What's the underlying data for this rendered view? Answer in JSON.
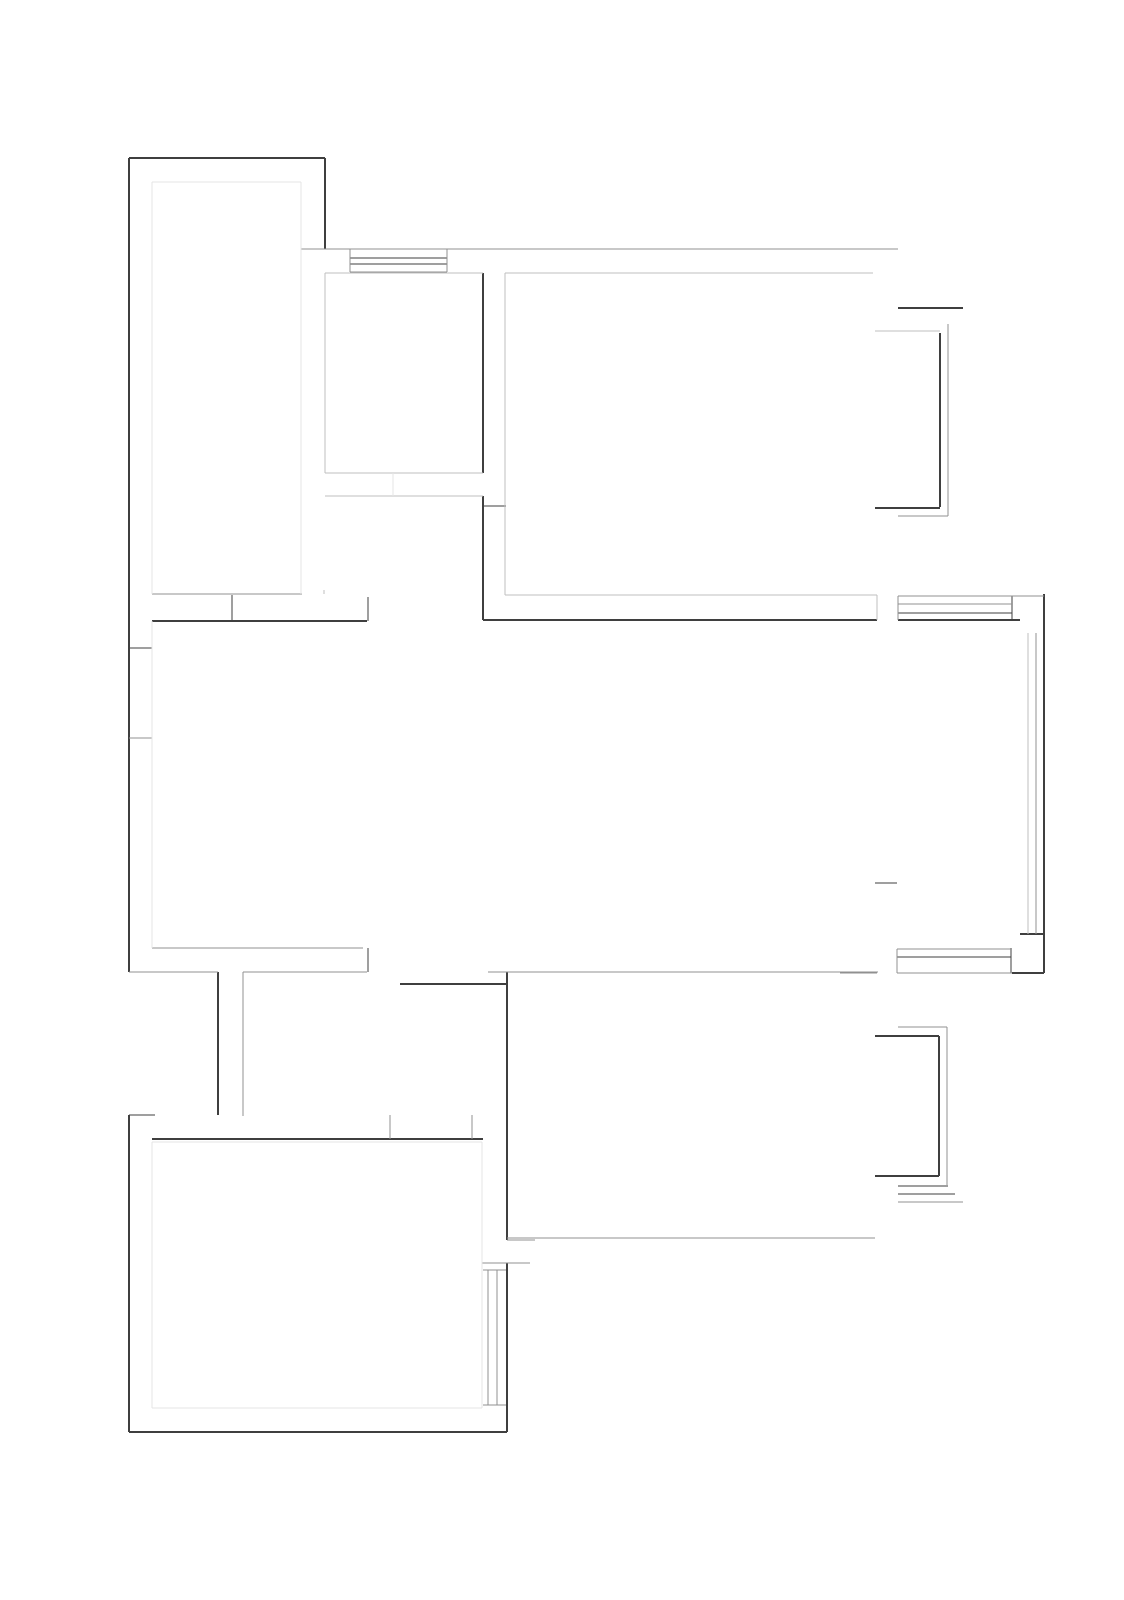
{
  "drawing": {
    "kind": "architectural-floor-plan",
    "width": 1124,
    "height": 1600,
    "background": "#ffffff"
  },
  "palette": {
    "dark": "#3f3f3f",
    "mid": "#909090",
    "light": "#bfbfbf",
    "faint": "#e4e4e4"
  },
  "layers": {
    "walls": {
      "color": "dark",
      "default_width": 2,
      "segment_name": "wall-segment",
      "segments": [
        [
          129,
          158,
          325,
          158,
          2
        ],
        [
          129,
          158,
          129,
          972,
          2
        ],
        [
          129,
          1115,
          129,
          1432,
          2
        ],
        [
          129,
          1432,
          507,
          1432,
          2
        ],
        [
          507,
          972,
          507,
          1240,
          2
        ],
        [
          507,
          1263,
          507,
          1432,
          2
        ],
        [
          325,
          158,
          325,
          249,
          2
        ],
        [
          483,
          273,
          483,
          473,
          1.6
        ],
        [
          483,
          496,
          483,
          620,
          1.6
        ],
        [
          483,
          620,
          877,
          620,
          1.8
        ],
        [
          898,
          620,
          1020,
          620,
          1.8
        ],
        [
          152,
          621,
          367,
          621,
          1.8
        ],
        [
          232,
          595,
          232,
          621,
          1.4
        ],
        [
          368,
          597,
          368,
          621,
          1.4
        ],
        [
          129,
          648,
          152,
          648,
          1.4
        ],
        [
          898,
          308,
          963,
          308,
          1.6
        ],
        [
          940,
          333,
          940,
          507,
          1.6
        ],
        [
          875,
          508,
          940,
          508,
          1.6
        ],
        [
          1044,
          594,
          1044,
          973,
          2
        ],
        [
          1020,
          934,
          1044,
          934,
          1.6
        ],
        [
          875,
          883,
          897,
          883,
          1.4
        ],
        [
          368,
          948,
          368,
          972,
          1.4
        ],
        [
          218,
          972,
          218,
          1115,
          1.6
        ],
        [
          129,
          1115,
          155,
          1115,
          1.4
        ],
        [
          152,
          1139,
          483,
          1139,
          1.8
        ],
        [
          400,
          984,
          507,
          984,
          1.6
        ],
        [
          875,
          1036,
          939,
          1036,
          1.6
        ],
        [
          939,
          1036,
          939,
          1176,
          1.6
        ],
        [
          875,
          1176,
          939,
          1176,
          1.6
        ],
        [
          1011,
          948,
          1011,
          973,
          1.4
        ],
        [
          1012,
          973,
          1044,
          973,
          1.6
        ],
        [
          483,
          506,
          506,
          506,
          1.4
        ],
        [
          1012,
          596,
          1012,
          620,
          1.4
        ]
      ]
    },
    "windows": {
      "color": "dark",
      "default_width": 1.3,
      "segment_name": "window-line",
      "segments": [
        [
          350,
          258,
          447,
          258,
          1.3
        ],
        [
          350,
          264,
          447,
          264,
          1.3
        ],
        [
          898,
          613,
          1012,
          613,
          1.3
        ],
        [
          898,
          1186,
          948,
          1186,
          1.3
        ],
        [
          898,
          1194,
          955,
          1194,
          1.3
        ],
        [
          897,
          957,
          1011,
          957,
          1.3
        ]
      ]
    },
    "partitions": {
      "color": "mid",
      "default_width": 1.2,
      "segment_name": "partition-segment",
      "segments": [
        [
          301,
          249,
          898,
          249,
          1.4
        ],
        [
          152,
          594,
          302,
          594,
          1.2
        ],
        [
          350,
          249,
          350,
          272,
          1
        ],
        [
          447,
          249,
          447,
          272,
          1
        ],
        [
          350,
          272,
          447,
          272,
          1.2
        ],
        [
          948,
          324,
          948,
          516,
          1.2
        ],
        [
          898,
          516,
          948,
          516,
          1.2
        ],
        [
          898,
          596,
          1044,
          596,
          1.2
        ],
        [
          898,
          604,
          1012,
          604,
          1.2
        ],
        [
          1036,
          633,
          1036,
          934,
          1.2
        ],
        [
          129,
          738,
          152,
          738,
          1.2
        ],
        [
          152,
          948,
          363,
          948,
          1.2
        ],
        [
          129,
          972,
          218,
          972,
          1.4
        ],
        [
          243,
          972,
          367,
          972,
          1.4
        ],
        [
          243,
          972,
          243,
          1116,
          1.2
        ],
        [
          390,
          1115,
          390,
          1139,
          1.2
        ],
        [
          472,
          1115,
          472,
          1139,
          1.2
        ],
        [
          488,
          972,
          878,
          972,
          1.2
        ],
        [
          507,
          1238,
          875,
          1238,
          1.2
        ],
        [
          482,
          1263,
          530,
          1263,
          1.2
        ],
        [
          507,
          1240,
          535,
          1240,
          1.2
        ],
        [
          897,
          949,
          1011,
          949,
          1.2
        ],
        [
          840,
          973,
          877,
          973,
          1.2
        ],
        [
          897,
          973,
          1012,
          973,
          1.2
        ],
        [
          898,
          1027,
          947,
          1027,
          1.2
        ],
        [
          947,
          1027,
          947,
          1185,
          1.2
        ],
        [
          898,
          1202,
          963,
          1202,
          1.2
        ],
        [
          483,
          1270,
          506,
          1270,
          1
        ],
        [
          483,
          1405,
          506,
          1405,
          1
        ],
        [
          488,
          1270,
          488,
          1405,
          1.2
        ],
        [
          497,
          1270,
          497,
          1405,
          1.2
        ],
        [
          898,
          596,
          898,
          620,
          1
        ],
        [
          897,
          949,
          897,
          973,
          1
        ]
      ]
    },
    "outlines": {
      "color": "light",
      "default_width": 1.2,
      "segment_name": "room-outline-segment",
      "segments": [
        [
          505,
          273,
          873,
          273,
          1.2
        ],
        [
          505,
          273,
          505,
          595,
          1.2
        ],
        [
          505,
          595,
          877,
          595,
          1.2
        ],
        [
          877,
          595,
          877,
          620,
          1.2
        ],
        [
          875,
          331,
          940,
          331,
          1.2
        ],
        [
          1028,
          633,
          1028,
          934,
          1.2
        ],
        [
          325,
          273,
          483,
          273,
          1.2
        ],
        [
          325,
          273,
          325,
          473,
          1.2
        ],
        [
          325,
          473,
          483,
          473,
          1.2
        ],
        [
          325,
          496,
          483,
          496,
          1.2
        ],
        [
          324,
          590,
          324,
          594,
          1.2
        ]
      ]
    },
    "traces": {
      "color": "faint",
      "default_width": 1.2,
      "segment_name": "faint-outline-segment",
      "segments": [
        [
          152,
          182,
          301,
          182,
          1.2
        ],
        [
          152,
          182,
          152,
          594,
          1.2
        ],
        [
          301,
          182,
          301,
          594,
          1.2
        ],
        [
          152,
          621,
          152,
          948,
          1.2
        ],
        [
          393,
          473,
          393,
          496,
          1.2
        ],
        [
          152,
          1142,
          482,
          1142,
          1.2
        ],
        [
          482,
          1142,
          482,
          1408,
          1.2
        ],
        [
          152,
          1408,
          482,
          1408,
          1.2
        ],
        [
          152,
          1142,
          152,
          1408,
          1.2
        ]
      ]
    }
  }
}
